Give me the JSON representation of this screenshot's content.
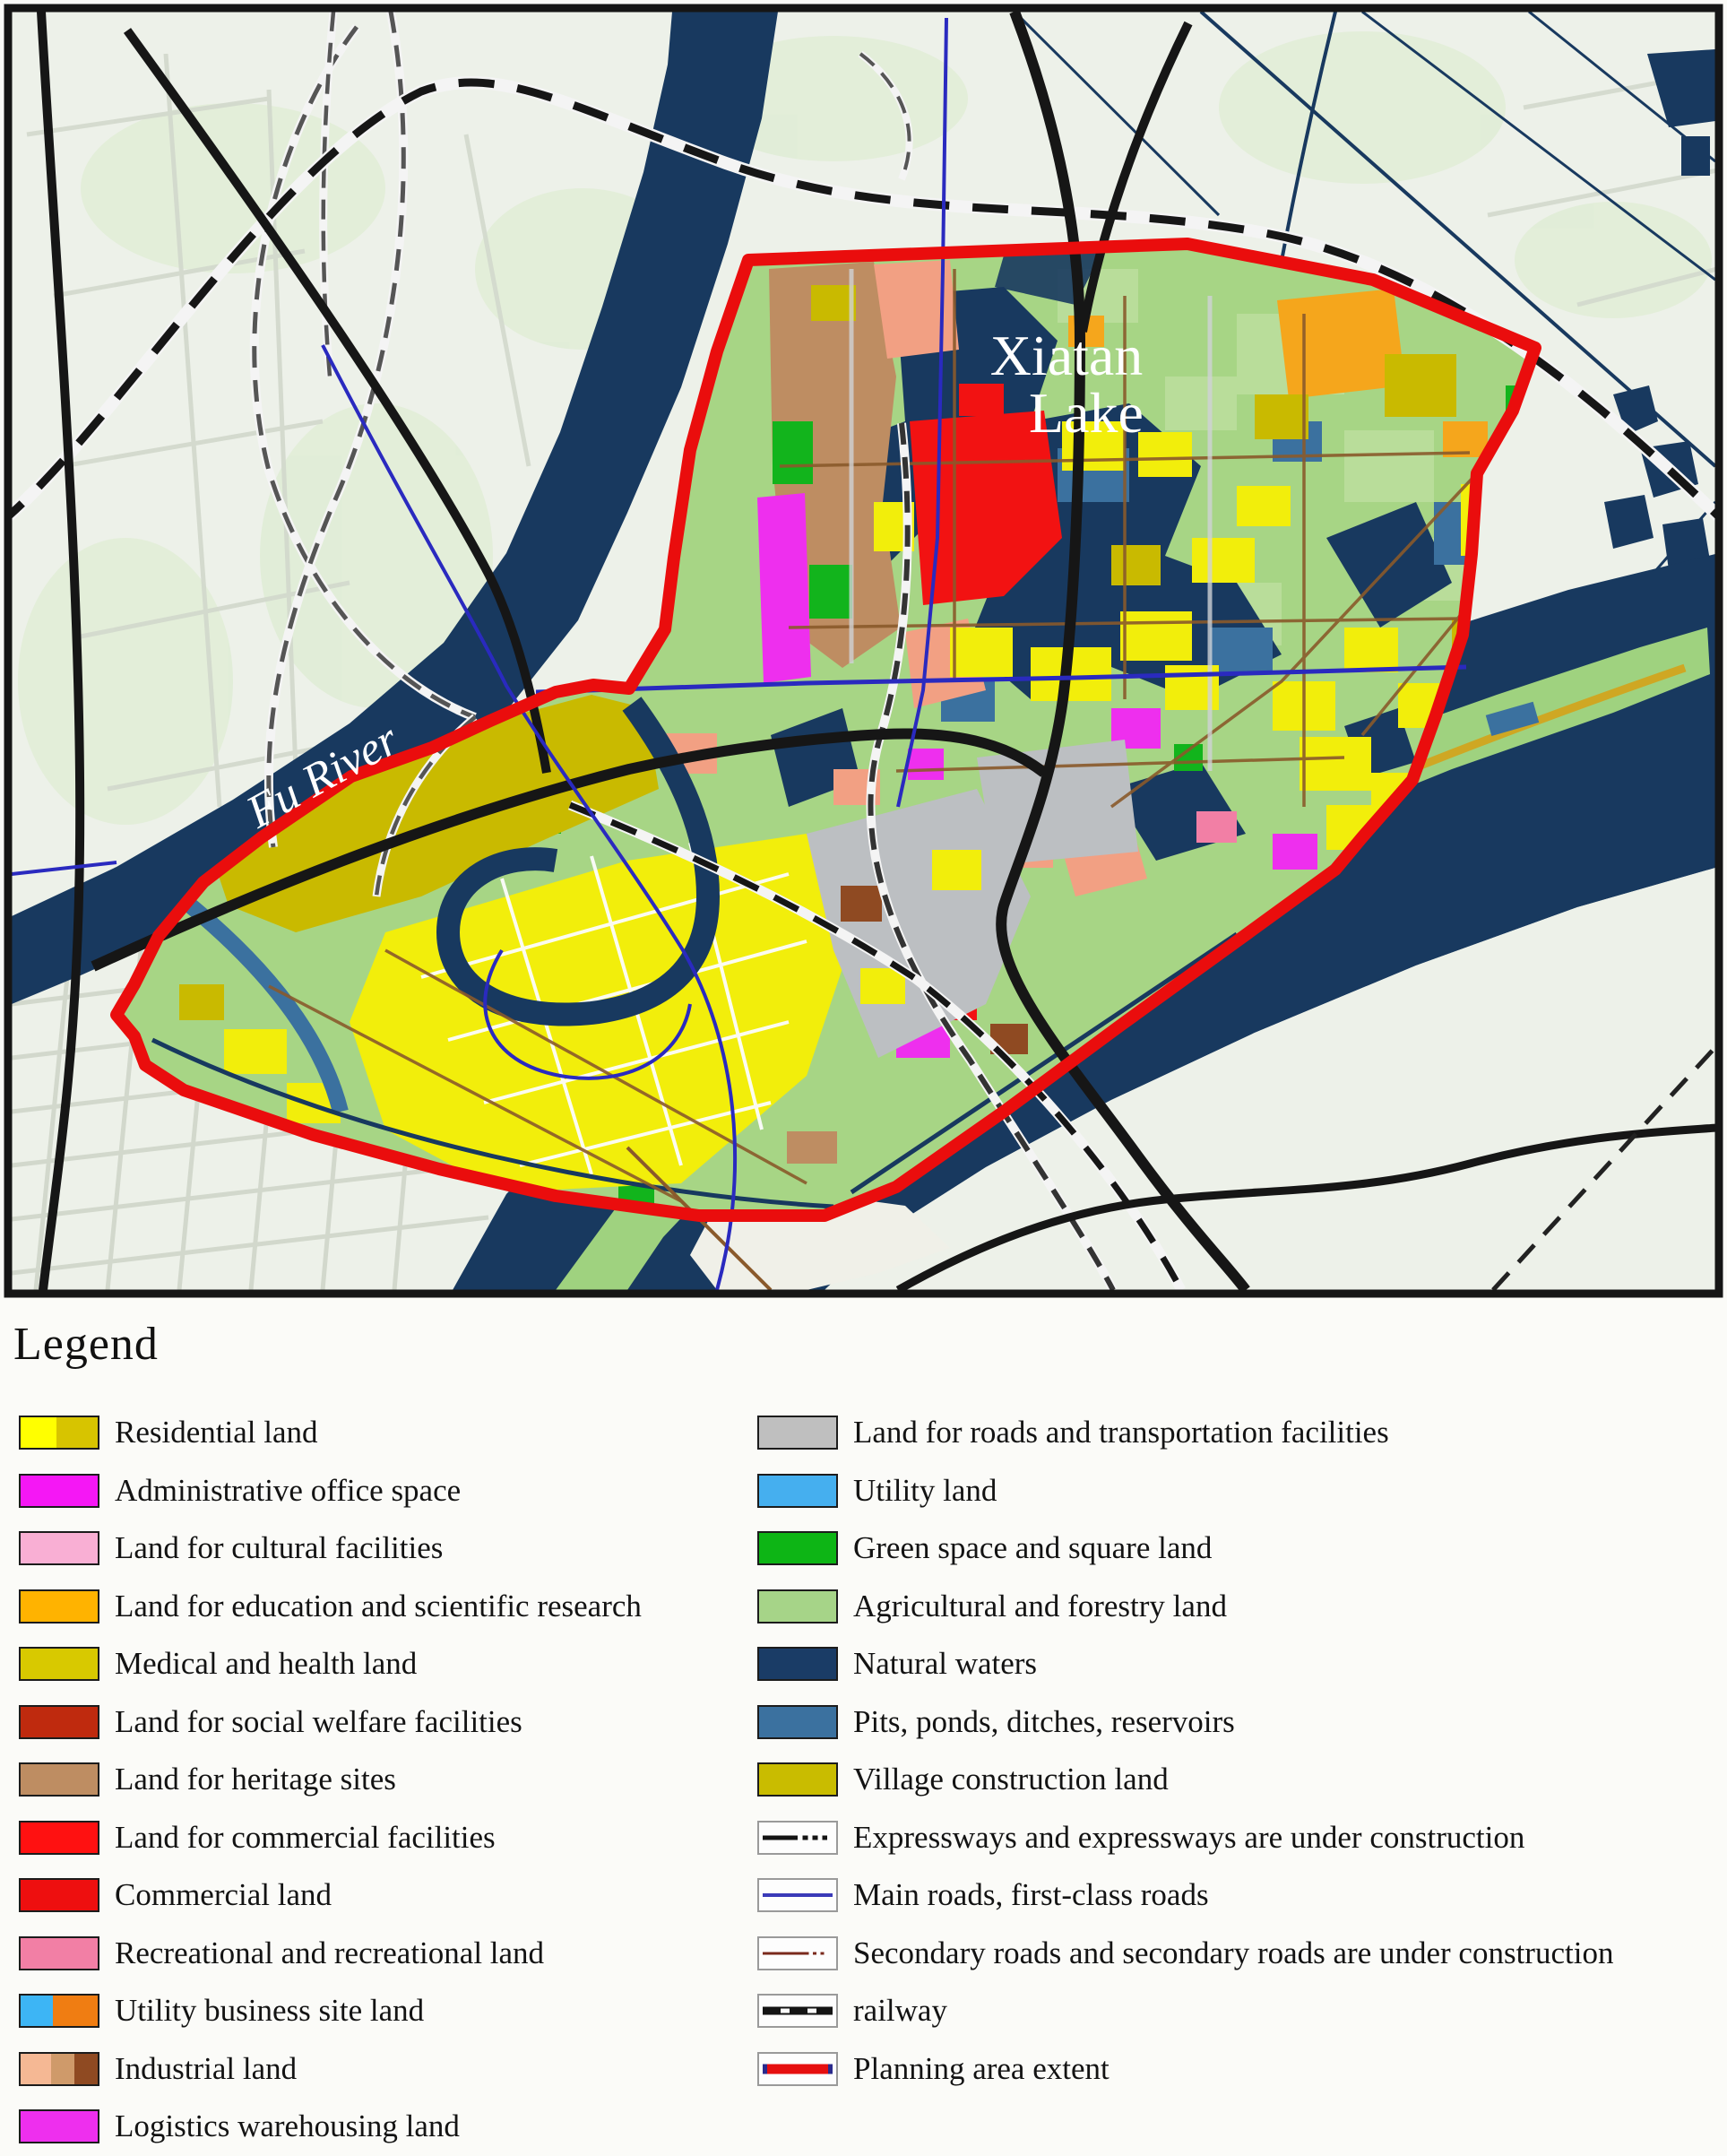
{
  "map": {
    "labels": {
      "lake_line1": "Xiatan",
      "lake_line2": "Lake",
      "river": "Fu River"
    }
  },
  "colors": {
    "map_bg": "#edf1e9",
    "map_tint": "#e0edd6",
    "water_navy": "#18395f",
    "water_steel": "#3b719f",
    "island_green": "#9fd27f",
    "agri_green": "#a7d585",
    "agri_light": "#b9dd9a",
    "boundary_red": "#ea0d0d",
    "road_black": "#161616",
    "road_blue": "#2a2abf",
    "road_brown": "#8a5a2b",
    "road_pale": "#d2d8cc",
    "rail_white": "#f4f4f4",
    "exp_gray": "#555555",
    "gold_road": "#cfa723",
    "residential_yellow": "#f2ee0b",
    "village_olive": "#c9ba00",
    "heritage_tan": "#be8d62",
    "salmon": "#f2a083",
    "magenta": "#ee2fee",
    "commercial_red": "#f21212",
    "orange": "#f5a61c",
    "green_space": "#12b41c",
    "gray_land": "#bcbfc2",
    "pink": "#f27fa5",
    "industrial_brown": "#8f4a22",
    "ivory": "#f0f0e8",
    "label_white": "#ffffff",
    "frame": "#161616"
  },
  "legend": {
    "title": "Legend",
    "left_items": [
      {
        "key": "residential-land",
        "label": "Residential land",
        "swatch": {
          "kind": "split",
          "colors": [
            "#ffff00",
            "#d7c400"
          ],
          "widths": [
            46,
            54
          ]
        }
      },
      {
        "key": "administrative-office-space",
        "label": "Administrative office space",
        "swatch": {
          "kind": "solid",
          "color": "#f517f5"
        }
      },
      {
        "key": "cultural-facilities",
        "label": "Land for cultural facilities",
        "swatch": {
          "kind": "solid",
          "color": "#f9afd4"
        }
      },
      {
        "key": "education-scientific-research",
        "label": "Land for education and scientific research",
        "swatch": {
          "kind": "solid",
          "color": "#ffb300"
        }
      },
      {
        "key": "medical-health-land",
        "label": "Medical and health land",
        "swatch": {
          "kind": "solid",
          "color": "#d8c900"
        }
      },
      {
        "key": "social-welfare-facilities",
        "label": "Land for social welfare facilities",
        "swatch": {
          "kind": "solid",
          "color": "#bf2a0e"
        }
      },
      {
        "key": "heritage-sites",
        "label": "Land for heritage sites",
        "swatch": {
          "kind": "solid",
          "color": "#be8d62"
        }
      },
      {
        "key": "commercial-facilities",
        "label": "Land for commercial facilities",
        "swatch": {
          "kind": "solid",
          "color": "#ff1111"
        }
      },
      {
        "key": "commercial-land",
        "label": "Commercial land",
        "swatch": {
          "kind": "solid",
          "color": "#ee0f0f"
        }
      },
      {
        "key": "recreational-land",
        "label": "Recreational and recreational land",
        "swatch": {
          "kind": "solid",
          "color": "#f27fa5"
        }
      },
      {
        "key": "utility-business-site-land",
        "label": "Utility business site land",
        "swatch": {
          "kind": "split",
          "colors": [
            "#3db5f5",
            "#f07d12"
          ],
          "widths": [
            42,
            58
          ]
        }
      },
      {
        "key": "industrial-land",
        "label": "Industrial land",
        "swatch": {
          "kind": "split",
          "colors": [
            "#f5b894",
            "#cf9a6a",
            "#8f4a22"
          ],
          "widths": [
            40,
            30,
            30
          ]
        }
      },
      {
        "key": "logistics-warehousing-land",
        "label": "Logistics warehousing land",
        "swatch": {
          "kind": "solid",
          "color": "#ee2fee"
        }
      }
    ],
    "right_items": [
      {
        "key": "roads-transportation-facilities",
        "label": "Land for roads and transportation facilities",
        "swatch": {
          "kind": "solid",
          "color": "#bfbfbf"
        }
      },
      {
        "key": "utility-land",
        "label": "Utility land",
        "swatch": {
          "kind": "solid",
          "color": "#45afef"
        }
      },
      {
        "key": "green-space-square-land",
        "label": "Green space and square land",
        "swatch": {
          "kind": "solid",
          "color": "#0db515"
        }
      },
      {
        "key": "agricultural-forestry-land",
        "label": "Agricultural and forestry land",
        "swatch": {
          "kind": "solid",
          "color": "#a6d488"
        }
      },
      {
        "key": "natural-waters",
        "label": "Natural waters",
        "swatch": {
          "kind": "solid",
          "color": "#1a3c66"
        }
      },
      {
        "key": "pits-ponds-ditches-reservoirs",
        "label": "Pits, ponds, ditches, reservoirs",
        "swatch": {
          "kind": "solid",
          "color": "#3b719f"
        }
      },
      {
        "key": "village-construction-land",
        "label": "Village construction land",
        "swatch": {
          "kind": "solid",
          "color": "#c9bc00"
        }
      },
      {
        "key": "expressways",
        "label": "Expressways and expressways are under construction",
        "swatch": {
          "kind": "line",
          "style": "expressway",
          "line_color": "#141414"
        }
      },
      {
        "key": "main-roads",
        "label": "Main roads, first-class roads",
        "swatch": {
          "kind": "line",
          "style": "main",
          "line_color": "#3a3ab8"
        }
      },
      {
        "key": "secondary-roads",
        "label": "Secondary roads and secondary roads are under construction",
        "swatch": {
          "kind": "line",
          "style": "secondary",
          "line_color": "#7a2a1d"
        }
      },
      {
        "key": "railway",
        "label": "railway",
        "swatch": {
          "kind": "line",
          "style": "railway",
          "line_color": "#141414"
        }
      },
      {
        "key": "planning-area-extent",
        "label": "Planning area extent",
        "swatch": {
          "kind": "line",
          "style": "planning",
          "line_color": "#e60f0f"
        }
      }
    ]
  }
}
